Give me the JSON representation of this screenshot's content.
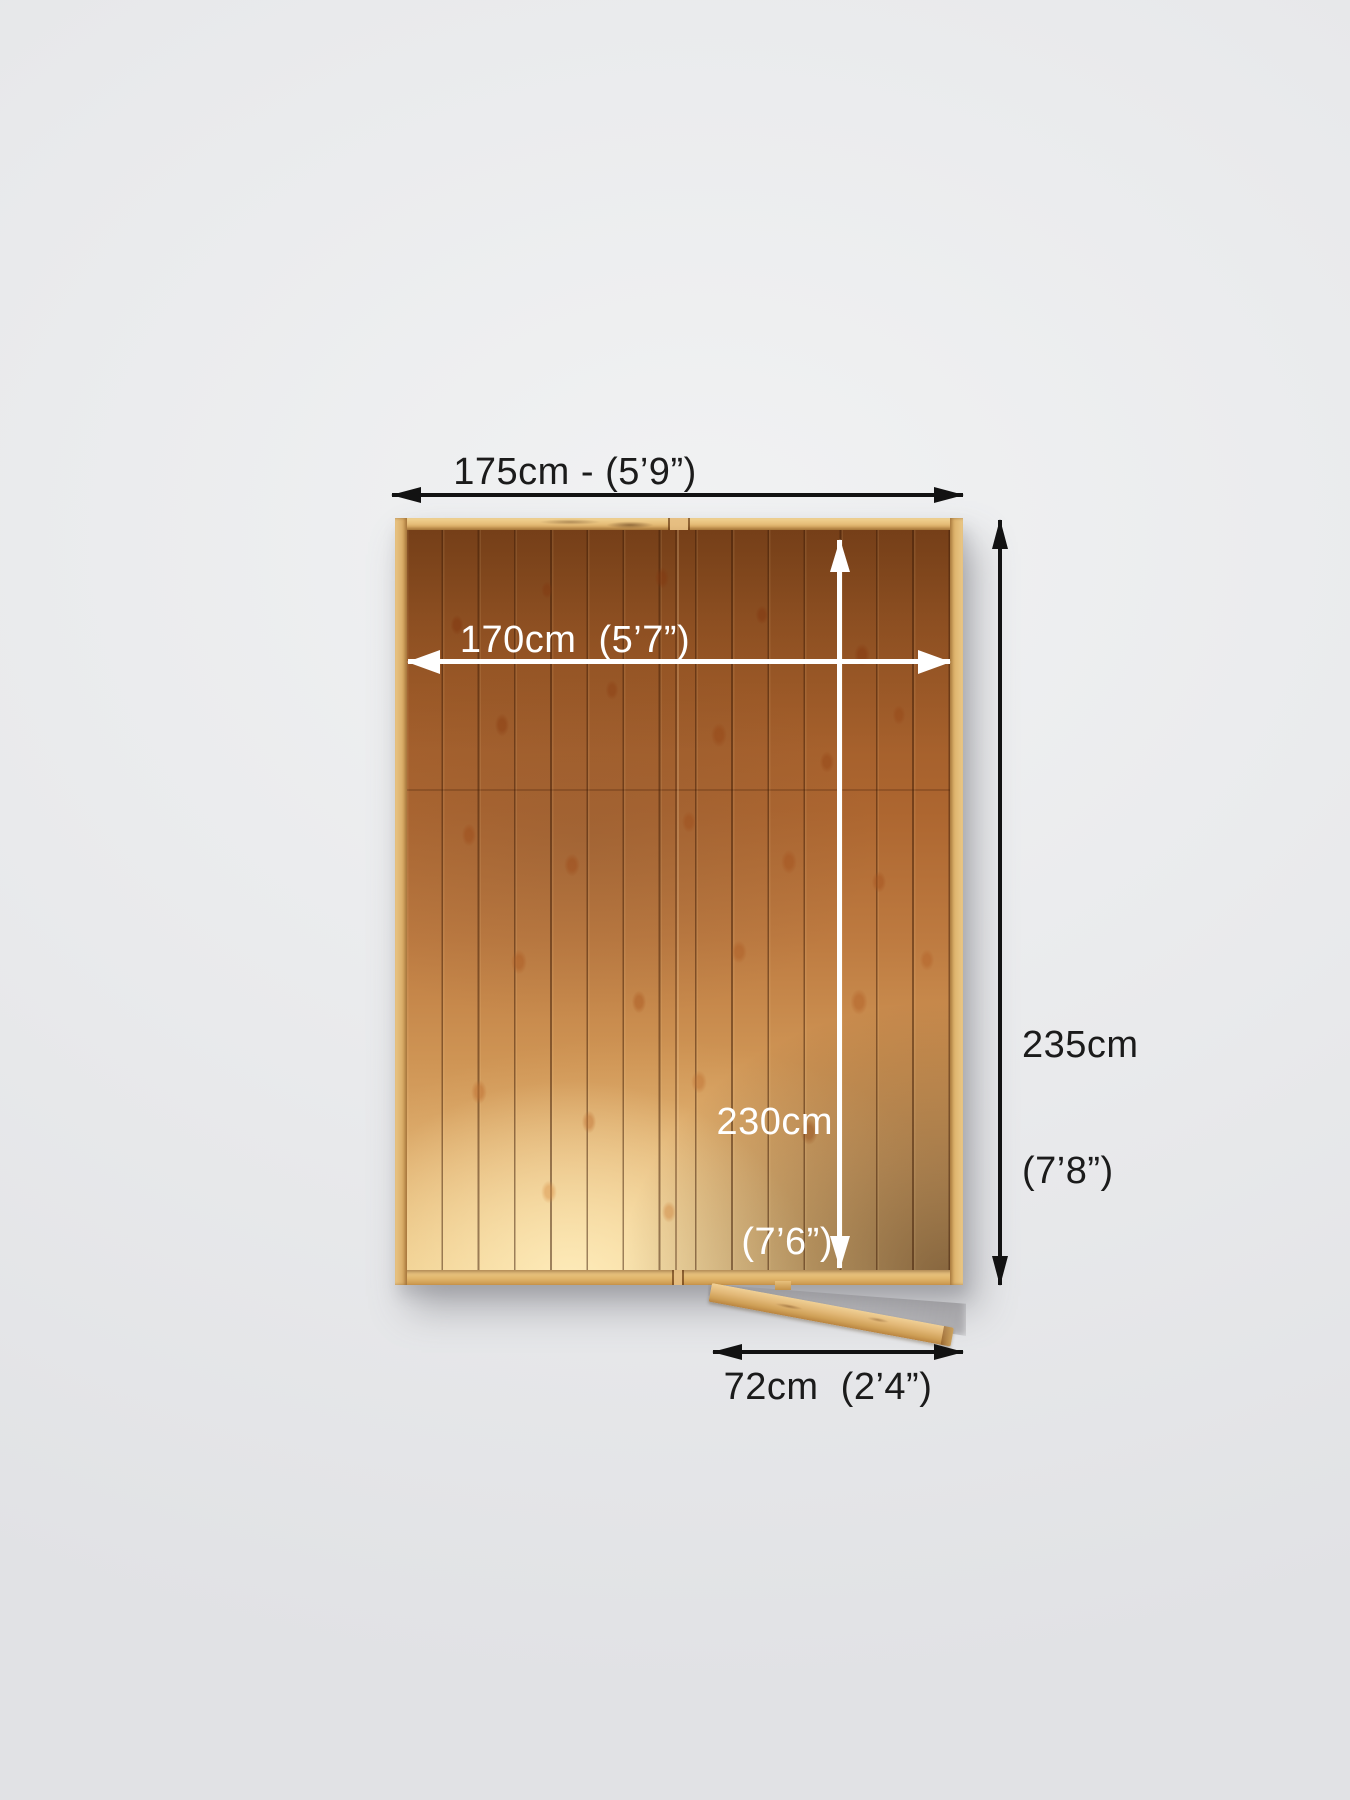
{
  "title": "Shed base top view with dimensions",
  "colors": {
    "background": "#e9eaec",
    "label_dark": "#1b1b1b",
    "label_light": "#ffffff",
    "arrow_dark": "#121212",
    "arrow_light": "#ffffff",
    "frame_wood": "#e8c17d",
    "frame_wood_dark": "#c9964c",
    "plank_wood": "#b06a31",
    "plank_wood_dark": "#8c4e21",
    "plank_highlight": "#f3d8a2",
    "shadow_wood": "#5d3312",
    "door_wood": "#e2b877"
  },
  "dimensions": {
    "outer_width": {
      "label": "175cm - (5’9”)",
      "value_cm": 175,
      "imperial": "5’9”"
    },
    "inner_width": {
      "label": "170cm  (5’7”)",
      "value_cm": 170,
      "imperial": "5’7”"
    },
    "outer_depth": {
      "line1": "235cm",
      "line2": "(7’8”)",
      "value_cm": 235,
      "imperial": "7’8”"
    },
    "inner_depth": {
      "line1": "230cm",
      "line2": "(7’6”)",
      "value_cm": 230,
      "imperial": "7’6”"
    },
    "door_width": {
      "label": "72cm  (2’4”)",
      "value_cm": 72,
      "imperial": "2’4”"
    }
  }
}
